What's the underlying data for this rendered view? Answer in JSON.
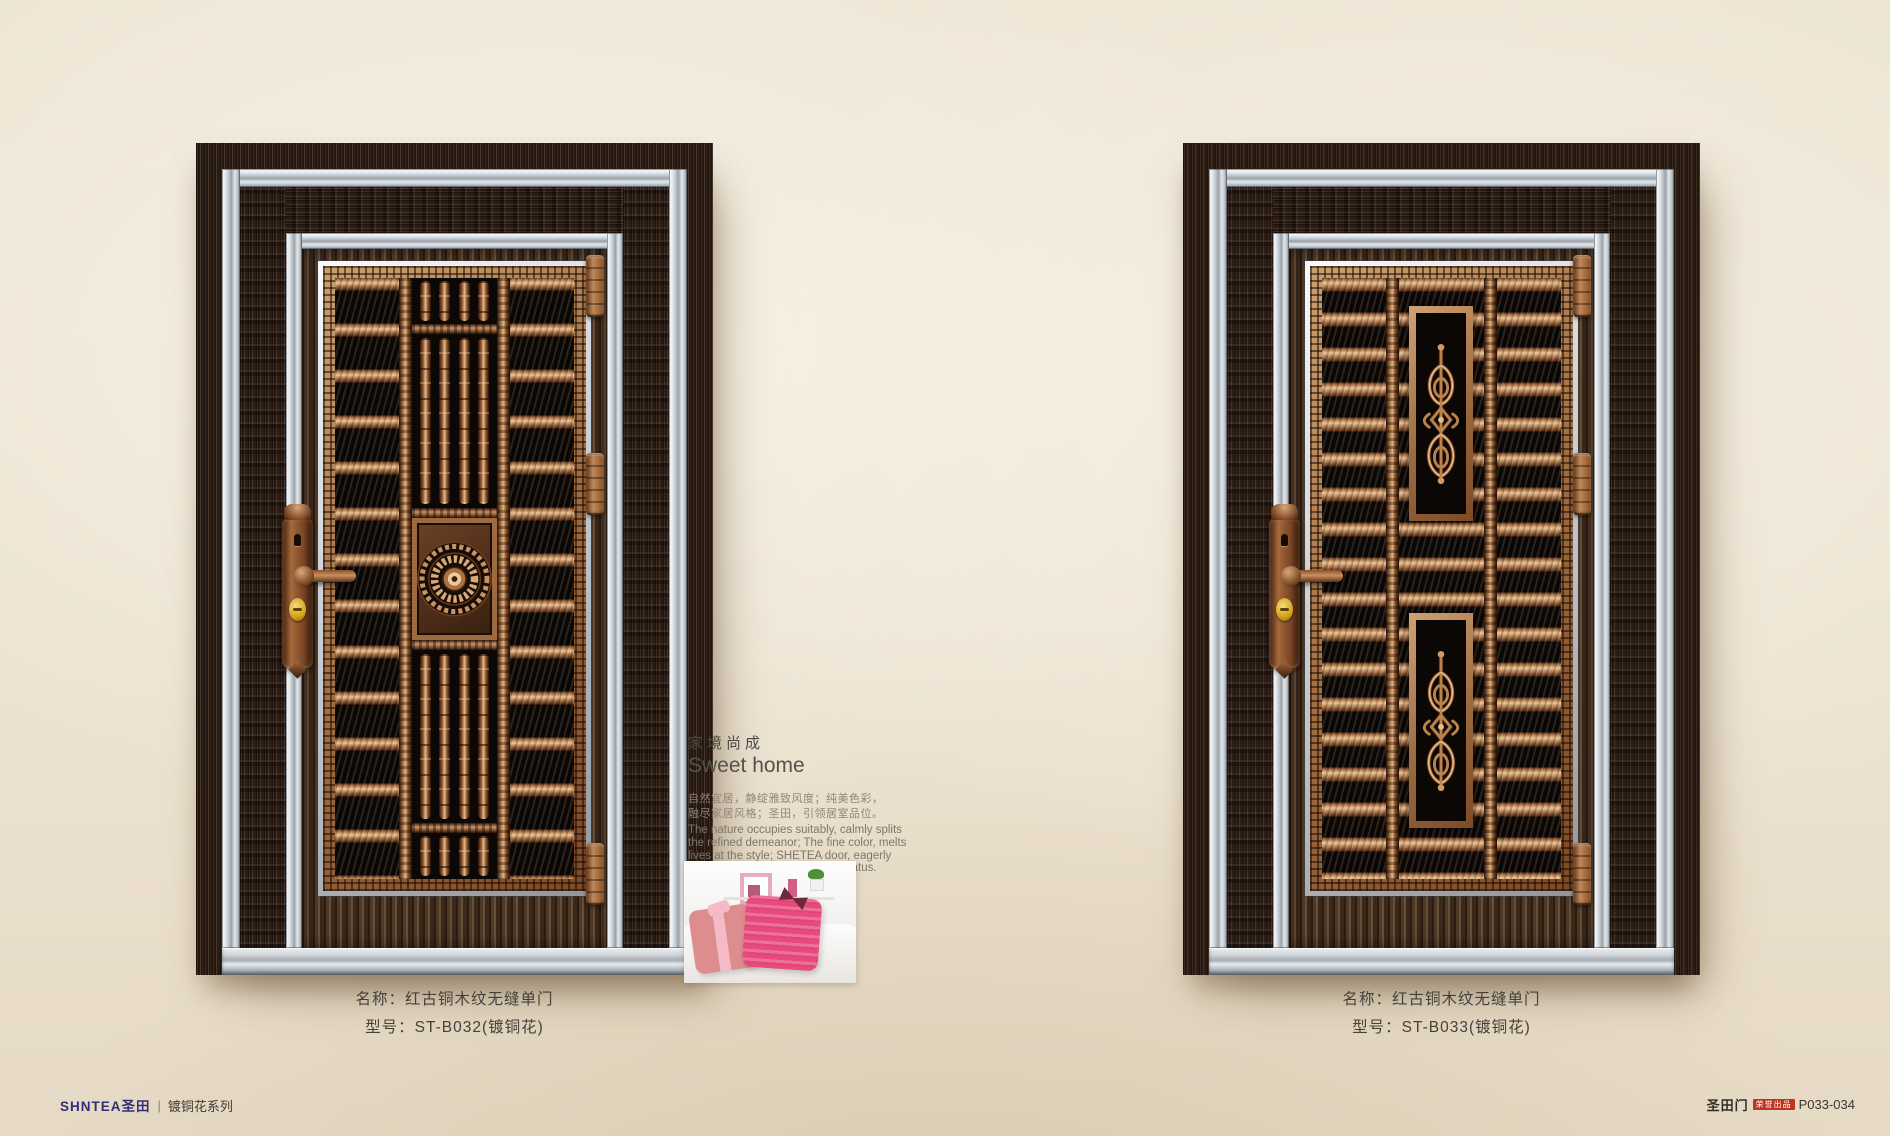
{
  "page": {
    "footer_left": {
      "logo": "SHNTEA圣田",
      "separator": "|",
      "series": "镀铜花系列"
    },
    "footer_right": {
      "brand": "圣田门",
      "badge": "荣誉出品",
      "page_no": "P033-034"
    }
  },
  "intro": {
    "title_cn": "家境尚成",
    "title_en": "Sweet home",
    "body_cn": [
      "自然宜居，静绽雅致风度；纯美色彩，",
      "融尽家居风格；圣田，引领居室品位。"
    ],
    "body_en": [
      "The nature occupies suitably, calmly splits",
      "the refined demeanor; The fine color, melts",
      "lives at the style; SHETEA door, eagerly",
      "anticipated the room personal status."
    ]
  },
  "doors": [
    {
      "caption_name": "名称：红古铜木纹无缝单门",
      "caption_model": "型号：ST-B032(镀铜花)",
      "model": "ST-B032",
      "decor": "turned copper balusters with center rosette medallion"
    },
    {
      "caption_name": "名称：红古铜木纹无缝单门",
      "caption_model": "型号：ST-B033(镀铜花)",
      "model": "ST-B033",
      "decor": "copper slats with two scroll ironwork medallions"
    }
  ],
  "colors": {
    "wall": "#ece2d0",
    "copper": "#b9834f",
    "steel": "#ccd3d8",
    "wood": "#3a2a20",
    "panel_background": "#0c0805",
    "logo_navy": "#312e79",
    "badge_red": "#c23320"
  }
}
